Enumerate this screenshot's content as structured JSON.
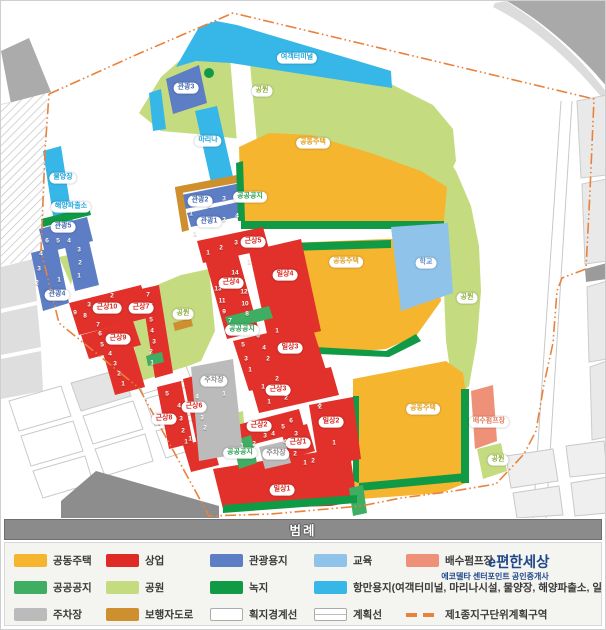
{
  "legend": {
    "title": "범례",
    "brand": {
      "name": "e편한세상",
      "subtitle": "에코델타 센터포인트 공인중개사"
    },
    "items": [
      {
        "label": "공동주택",
        "type": "fill",
        "color": "#F6B52E",
        "row": 0,
        "col": 0
      },
      {
        "label": "상업",
        "type": "fill",
        "color": "#DF2B25",
        "row": 0,
        "col": 1
      },
      {
        "label": "관광용지",
        "type": "fill",
        "color": "#5D7DC4",
        "row": 0,
        "col": 2
      },
      {
        "label": "교육",
        "type": "fill",
        "color": "#8FC3EA",
        "row": 0,
        "col": 3
      },
      {
        "label": "배수펌프장",
        "type": "fill",
        "color": "#EF9079",
        "row": 0,
        "col": 4
      },
      {
        "label": "공공공지",
        "type": "fill",
        "color": "#3FAE62",
        "row": 1,
        "col": 0
      },
      {
        "label": "공원",
        "type": "fill",
        "color": "#C5DB80",
        "row": 1,
        "col": 1
      },
      {
        "label": "녹지",
        "type": "fill",
        "color": "#119A45",
        "row": 1,
        "col": 2
      },
      {
        "label": "항만용지(여객터미널, 마리나시설, 물양장, 해양파출소, 일반부두",
        "type": "fill",
        "color": "#36B7E8",
        "row": 1,
        "col": 3
      },
      {
        "label": "주차장",
        "type": "fill",
        "color": "#BBBBBB",
        "row": 2,
        "col": 0
      },
      {
        "label": "보행자도로",
        "type": "fill",
        "color": "#CE8F2F",
        "row": 2,
        "col": 1
      },
      {
        "label": "획지경계선",
        "type": "outline",
        "color": "#FFFFFF",
        "row": 2,
        "col": 2
      },
      {
        "label": "계획선",
        "type": "outline2",
        "color": "#FFFFFF",
        "row": 2,
        "col": 3
      },
      {
        "label": "제1종지구단위계획구역",
        "type": "dash",
        "color": "#E8823C",
        "row": 2,
        "col": 4
      }
    ]
  },
  "map": {
    "pill_colors": {
      "cyan": "#19A5DB",
      "blue": "#4A6CB3",
      "red": "#D8251F",
      "green": "#2E9E52",
      "park": "#8FB13C",
      "yellow": "#E3A01C",
      "gray": "#8C8C8C",
      "salmon": "#E87C5E",
      "edu": "#5B8FD0"
    },
    "pills": [
      {
        "text": "여객터미널",
        "c": "cyan",
        "x": 296,
        "y": 57
      },
      {
        "text": "공원",
        "c": "park",
        "x": 261,
        "y": 90
      },
      {
        "text": "관광3",
        "c": "blue",
        "x": 185,
        "y": 87
      },
      {
        "text": "마리나",
        "c": "cyan",
        "x": 207,
        "y": 140
      },
      {
        "text": "물양장",
        "c": "cyan",
        "x": 62,
        "y": 177
      },
      {
        "text": "해양파출소",
        "c": "cyan",
        "x": 70,
        "y": 206
      },
      {
        "text": "관광5",
        "c": "blue",
        "x": 62,
        "y": 226
      },
      {
        "text": "관광4",
        "c": "blue",
        "x": 56,
        "y": 294
      },
      {
        "text": "관광2",
        "c": "blue",
        "x": 199,
        "y": 200
      },
      {
        "text": "공공공지",
        "c": "green",
        "x": 249,
        "y": 196
      },
      {
        "text": "관광1",
        "c": "blue",
        "x": 208,
        "y": 221
      },
      {
        "text": "근상5",
        "c": "red",
        "x": 252,
        "y": 241
      },
      {
        "text": "공동주택",
        "c": "yellow",
        "x": 312,
        "y": 142
      },
      {
        "text": "공동주택",
        "c": "yellow",
        "x": 345,
        "y": 261
      },
      {
        "text": "학교",
        "c": "edu",
        "x": 425,
        "y": 262
      },
      {
        "text": "공원",
        "c": "park",
        "x": 466,
        "y": 297
      },
      {
        "text": "공원",
        "c": "park",
        "x": 182,
        "y": 313
      },
      {
        "text": "근상10",
        "c": "red",
        "x": 106,
        "y": 307
      },
      {
        "text": "근상7",
        "c": "red",
        "x": 140,
        "y": 307
      },
      {
        "text": "근상9",
        "c": "red",
        "x": 117,
        "y": 338
      },
      {
        "text": "근상4",
        "c": "red",
        "x": 230,
        "y": 282
      },
      {
        "text": "일상4",
        "c": "red",
        "x": 284,
        "y": 274
      },
      {
        "text": "공공공지",
        "c": "green",
        "x": 241,
        "y": 329
      },
      {
        "text": "일상3",
        "c": "red",
        "x": 289,
        "y": 347
      },
      {
        "text": "근상3",
        "c": "red",
        "x": 277,
        "y": 389
      },
      {
        "text": "근상8",
        "c": "red",
        "x": 163,
        "y": 418
      },
      {
        "text": "근상6",
        "c": "red",
        "x": 193,
        "y": 406
      },
      {
        "text": "근상2",
        "c": "red",
        "x": 258,
        "y": 425
      },
      {
        "text": "근상1",
        "c": "red",
        "x": 297,
        "y": 442
      },
      {
        "text": "주차장",
        "c": "gray",
        "x": 275,
        "y": 453
      },
      {
        "text": "공공공지",
        "c": "green",
        "x": 239,
        "y": 452
      },
      {
        "text": "주차장",
        "c": "gray",
        "x": 213,
        "y": 380
      },
      {
        "text": "일상2",
        "c": "red",
        "x": 330,
        "y": 421
      },
      {
        "text": "일상1",
        "c": "red",
        "x": 281,
        "y": 489
      },
      {
        "text": "공동주택",
        "c": "yellow",
        "x": 422,
        "y": 408
      },
      {
        "text": "배수펌프장",
        "c": "salmon",
        "x": 488,
        "y": 421
      },
      {
        "text": "공원",
        "c": "park",
        "x": 497,
        "y": 459
      }
    ],
    "numbers": [
      {
        "t": "6",
        "x": 46,
        "y": 240
      },
      {
        "t": "5",
        "x": 57,
        "y": 240
      },
      {
        "t": "4",
        "x": 68,
        "y": 240
      },
      {
        "t": "4",
        "x": 40,
        "y": 253
      },
      {
        "t": "3",
        "x": 38,
        "y": 268
      },
      {
        "t": "2",
        "x": 36,
        "y": 282
      },
      {
        "t": "1",
        "x": 58,
        "y": 279
      },
      {
        "t": "3",
        "x": 78,
        "y": 249
      },
      {
        "t": "2",
        "x": 79,
        "y": 262
      },
      {
        "t": "1",
        "x": 78,
        "y": 275
      },
      {
        "t": "1",
        "x": 190,
        "y": 213
      },
      {
        "t": "2",
        "x": 208,
        "y": 205
      },
      {
        "t": "3",
        "x": 223,
        "y": 198
      },
      {
        "t": "1",
        "x": 194,
        "y": 233
      },
      {
        "t": "2",
        "x": 211,
        "y": 224
      },
      {
        "t": "3",
        "x": 223,
        "y": 219
      },
      {
        "t": "4",
        "x": 236,
        "y": 215
      },
      {
        "t": "1",
        "x": 207,
        "y": 252
      },
      {
        "t": "2",
        "x": 220,
        "y": 247
      },
      {
        "t": "3",
        "x": 235,
        "y": 242
      },
      {
        "t": "14",
        "x": 234,
        "y": 272
      },
      {
        "t": "13",
        "x": 217,
        "y": 288
      },
      {
        "t": "12",
        "x": 243,
        "y": 291
      },
      {
        "t": "11",
        "x": 221,
        "y": 300
      },
      {
        "t": "10",
        "x": 244,
        "y": 303
      },
      {
        "t": "9",
        "x": 223,
        "y": 311
      },
      {
        "t": "8",
        "x": 246,
        "y": 313
      },
      {
        "t": "7",
        "x": 229,
        "y": 320
      },
      {
        "t": "1",
        "x": 248,
        "y": 261
      },
      {
        "t": "1",
        "x": 276,
        "y": 330
      },
      {
        "t": "6",
        "x": 257,
        "y": 335
      },
      {
        "t": "5",
        "x": 242,
        "y": 344
      },
      {
        "t": "4",
        "x": 263,
        "y": 347
      },
      {
        "t": "3",
        "x": 245,
        "y": 358
      },
      {
        "t": "2",
        "x": 267,
        "y": 358
      },
      {
        "t": "1",
        "x": 249,
        "y": 369
      },
      {
        "t": "2",
        "x": 276,
        "y": 378
      },
      {
        "t": "1",
        "x": 262,
        "y": 386
      },
      {
        "t": "2",
        "x": 111,
        "y": 295
      },
      {
        "t": "3",
        "x": 88,
        "y": 304
      },
      {
        "t": "9",
        "x": 74,
        "y": 312
      },
      {
        "t": "8",
        "x": 84,
        "y": 315
      },
      {
        "t": "7",
        "x": 97,
        "y": 324
      },
      {
        "t": "7",
        "x": 147,
        "y": 294
      },
      {
        "t": "6",
        "x": 150,
        "y": 305
      },
      {
        "t": "5",
        "x": 150,
        "y": 319
      },
      {
        "t": "4",
        "x": 151,
        "y": 330
      },
      {
        "t": "3",
        "x": 153,
        "y": 341
      },
      {
        "t": "2",
        "x": 150,
        "y": 351
      },
      {
        "t": "1",
        "x": 151,
        "y": 362
      },
      {
        "t": "6",
        "x": 99,
        "y": 333
      },
      {
        "t": "5",
        "x": 101,
        "y": 344
      },
      {
        "t": "4",
        "x": 109,
        "y": 353
      },
      {
        "t": "3",
        "x": 114,
        "y": 363
      },
      {
        "t": "2",
        "x": 118,
        "y": 373
      },
      {
        "t": "1",
        "x": 122,
        "y": 383
      },
      {
        "t": "5",
        "x": 166,
        "y": 393
      },
      {
        "t": "4",
        "x": 178,
        "y": 405
      },
      {
        "t": "3",
        "x": 180,
        "y": 418
      },
      {
        "t": "2",
        "x": 182,
        "y": 430
      },
      {
        "t": "1",
        "x": 185,
        "y": 441
      },
      {
        "t": "4",
        "x": 196,
        "y": 396
      },
      {
        "t": "3",
        "x": 201,
        "y": 417
      },
      {
        "t": "2",
        "x": 204,
        "y": 427
      },
      {
        "t": "1",
        "x": 189,
        "y": 438
      },
      {
        "t": "1",
        "x": 268,
        "y": 401
      },
      {
        "t": "2",
        "x": 285,
        "y": 397
      },
      {
        "t": "2",
        "x": 318,
        "y": 404
      },
      {
        "t": "1",
        "x": 241,
        "y": 445
      },
      {
        "t": "2",
        "x": 253,
        "y": 443
      },
      {
        "t": "3",
        "x": 264,
        "y": 435
      },
      {
        "t": "4",
        "x": 272,
        "y": 433
      },
      {
        "t": "5",
        "x": 282,
        "y": 426
      },
      {
        "t": "6",
        "x": 290,
        "y": 420
      },
      {
        "t": "3",
        "x": 295,
        "y": 433
      },
      {
        "t": "4",
        "x": 284,
        "y": 441
      },
      {
        "t": "1",
        "x": 286,
        "y": 453
      },
      {
        "t": "2",
        "x": 294,
        "y": 453
      },
      {
        "t": "2",
        "x": 319,
        "y": 406
      },
      {
        "t": "1",
        "x": 333,
        "y": 442
      },
      {
        "t": "1",
        "x": 304,
        "y": 462
      },
      {
        "t": "2",
        "x": 312,
        "y": 460
      },
      {
        "t": "1",
        "x": 223,
        "y": 393
      }
    ]
  }
}
